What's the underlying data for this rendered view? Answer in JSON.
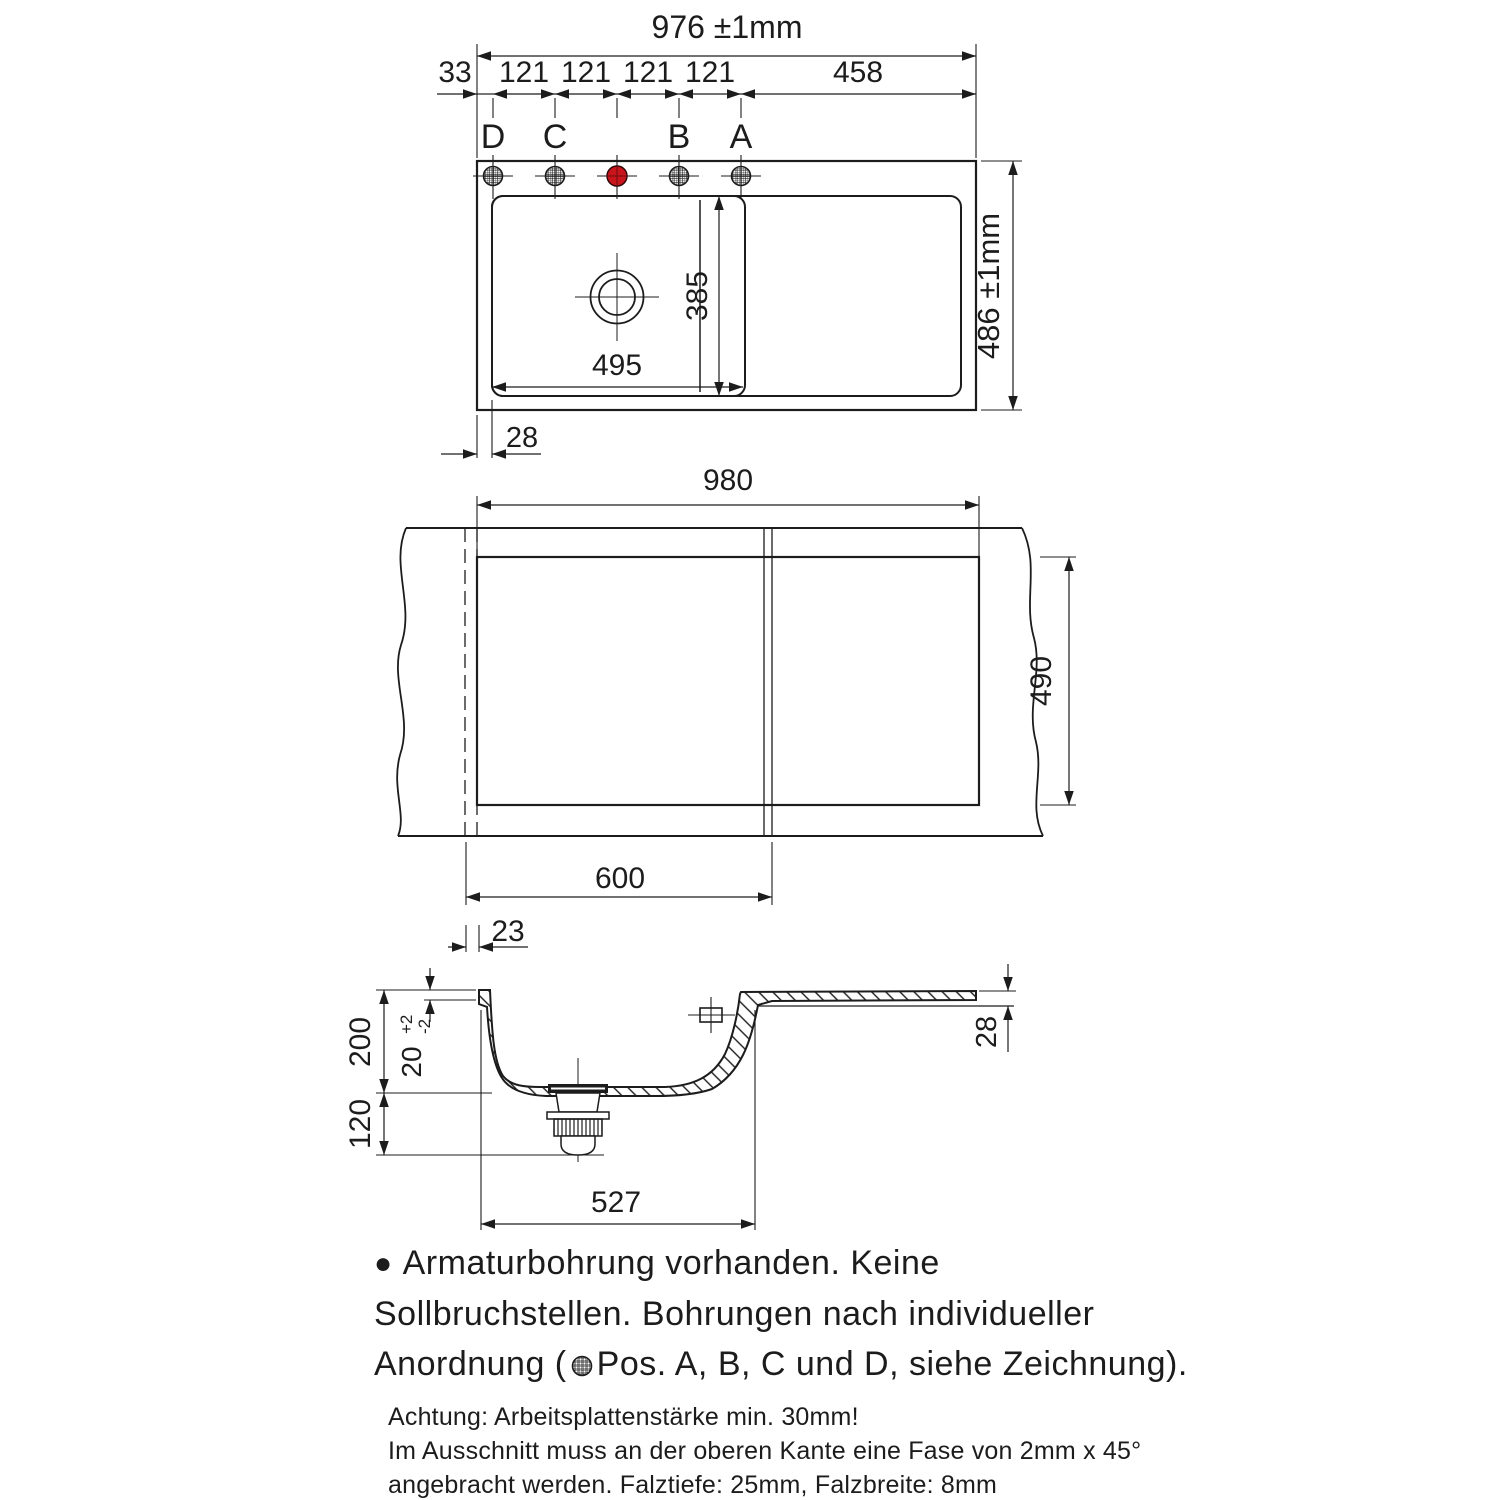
{
  "colors": {
    "line": "#1c1c1c",
    "red_hole": "#c8151b",
    "red_hole_dark": "#7d0e12",
    "background": "#ffffff"
  },
  "top_view": {
    "overall_width": "976 ±1mm",
    "chain": [
      "33",
      "121",
      "121",
      "121",
      "121",
      "458"
    ],
    "hole_labels": [
      "D",
      "C",
      "B",
      "A"
    ],
    "overall_depth": "486 ±1mm",
    "bowl_width": "495",
    "bowl_depth": "385",
    "edge_offset": "28"
  },
  "cutout_view": {
    "cutout_width": "980",
    "cutout_depth": "490",
    "cabinet_width": "600",
    "side_offset": "23"
  },
  "section_view": {
    "bowl_depth": "200",
    "edge_height": "20",
    "edge_tol_plus": "+2",
    "edge_tol_minus": "-2",
    "clearance_below": "120",
    "bowl_outer_width": "527",
    "rim_thickness": "28"
  },
  "notes": {
    "bullet": "●",
    "line1": "Armaturbohrung vorhanden. Keine",
    "line2": "Sollbruchstellen. Bohrungen nach individueller",
    "line3_prefix": "Anordnung (",
    "line3_suffix": "Pos. A, B, C und D, siehe Zeichnung)."
  },
  "fine_print": {
    "line1": "Achtung: Arbeitsplattenstärke min. 30mm!",
    "line2": "Im Ausschnitt muss an der oberen Kante eine Fase von 2mm x 45°",
    "line3": "angebracht werden. Falztiefe: 25mm, Falzbreite: 8mm"
  }
}
